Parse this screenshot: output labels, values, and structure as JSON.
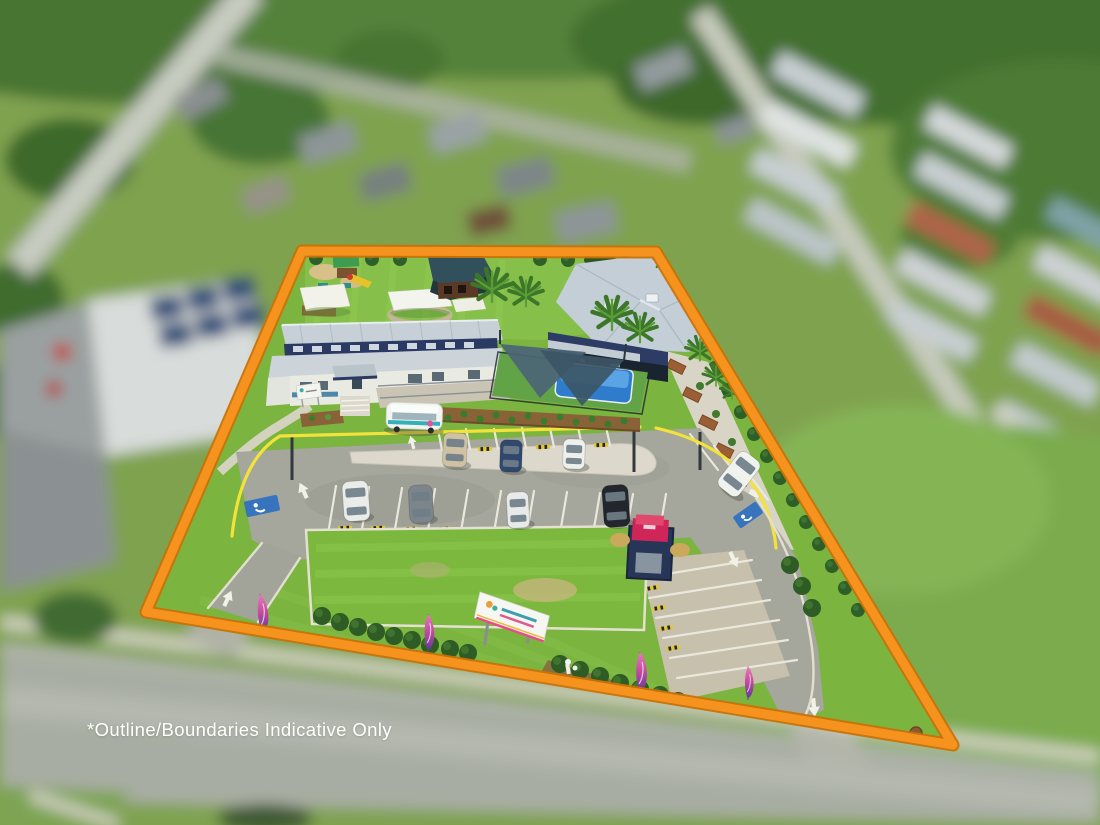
{
  "page": {
    "title": "Aerial property photograph with boundary outline"
  },
  "overlay": {
    "disclaimer": "*Outline/Boundaries Indicative Only"
  },
  "boundary": {
    "shape": "quadrilateral",
    "stroke_color": "#F6921E",
    "edge_color": "#C97206"
  },
  "colors": {
    "curb_yellow": "#F2E23A",
    "disclaimer_text": "#FFFFFF",
    "grass": "#7CB440",
    "asphalt": "#A5A69C",
    "roof_gray": "#C6D0D6",
    "building_navy": "#2B3A62",
    "pool_blue": "#2F7CCC",
    "flag_pink": "#C04A9E",
    "hedge_green": "#2F5F28"
  },
  "scene": {
    "style": "tilt-shift aerial photo, surroundings blurred, subject sharp",
    "site_features": [
      "childcare-buildings",
      "playground",
      "shade-sails",
      "pool-shade-area",
      "car-park",
      "grass-island",
      "v-shaped-signboard",
      "feather-flags",
      "bin-enclosure",
      "perimeter-fence",
      "conifer-hedge"
    ],
    "vehicle_count": 9,
    "road_markings": [
      "directional-arrows",
      "accessible-parking-symbols",
      "parking-bay-lines",
      "yellow-curb-lines"
    ]
  }
}
